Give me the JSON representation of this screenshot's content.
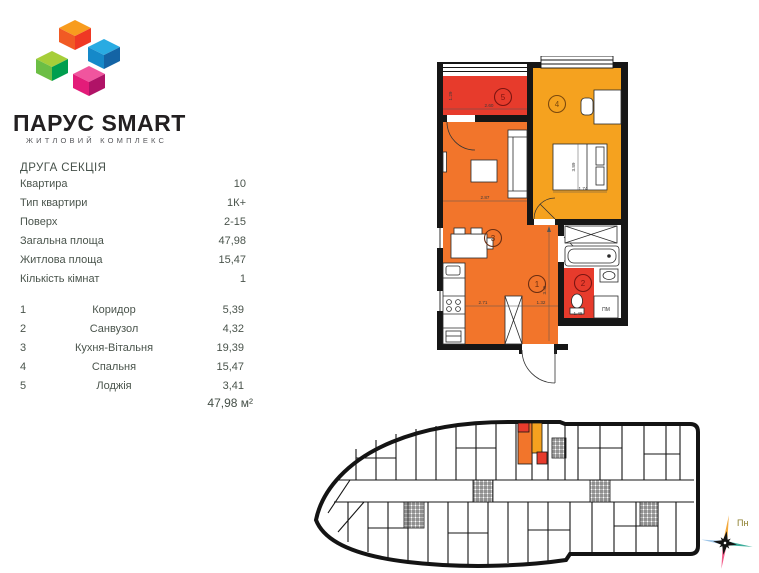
{
  "logo": {
    "title": "ПАРУС SMART",
    "subtitle": "ЖИТЛОВИЙ КОМПЛЕКС"
  },
  "details": {
    "section_title": "ДРУГА СЕКЦІЯ",
    "rows": [
      {
        "label": "Квартира",
        "value": "10"
      },
      {
        "label": "Тип квартири",
        "value": "1К+"
      },
      {
        "label": "Поверх",
        "value": "2-15"
      },
      {
        "label": "Загальна площа",
        "value": "47,98"
      },
      {
        "label": "Житлова площа",
        "value": "15,47"
      },
      {
        "label": "Кількість кімнат",
        "value": "1"
      }
    ]
  },
  "rooms": {
    "items": [
      {
        "num": "1",
        "name": "Коридор",
        "area": "5,39"
      },
      {
        "num": "2",
        "name": "Санвузол",
        "area": "4,32"
      },
      {
        "num": "3",
        "name": "Кухня-Вітальня",
        "area": "19,39"
      },
      {
        "num": "4",
        "name": "Спальня",
        "area": "15,47"
      },
      {
        "num": "5",
        "name": "Лоджія",
        "area": "3,41"
      }
    ],
    "total_area": "47,98 м²"
  },
  "floorplan": {
    "dims": {
      "loggia_width": "2.60",
      "loggia_depth": "1.29",
      "living_width": "2.87",
      "bedroom_length": "3.89",
      "bedroom_width": "1.74",
      "kitchen_width": "2.71",
      "corridor_width": "1.32",
      "corridor_length": "3.45",
      "bath_width": "1.48"
    },
    "washer_label": "ПМ"
  },
  "compass": {
    "north_label": "Пн"
  },
  "colors": {
    "orange": "#F2752B",
    "light_orange": "#F5A21F",
    "red": "#E73B2C",
    "wall_black": "#161616"
  }
}
